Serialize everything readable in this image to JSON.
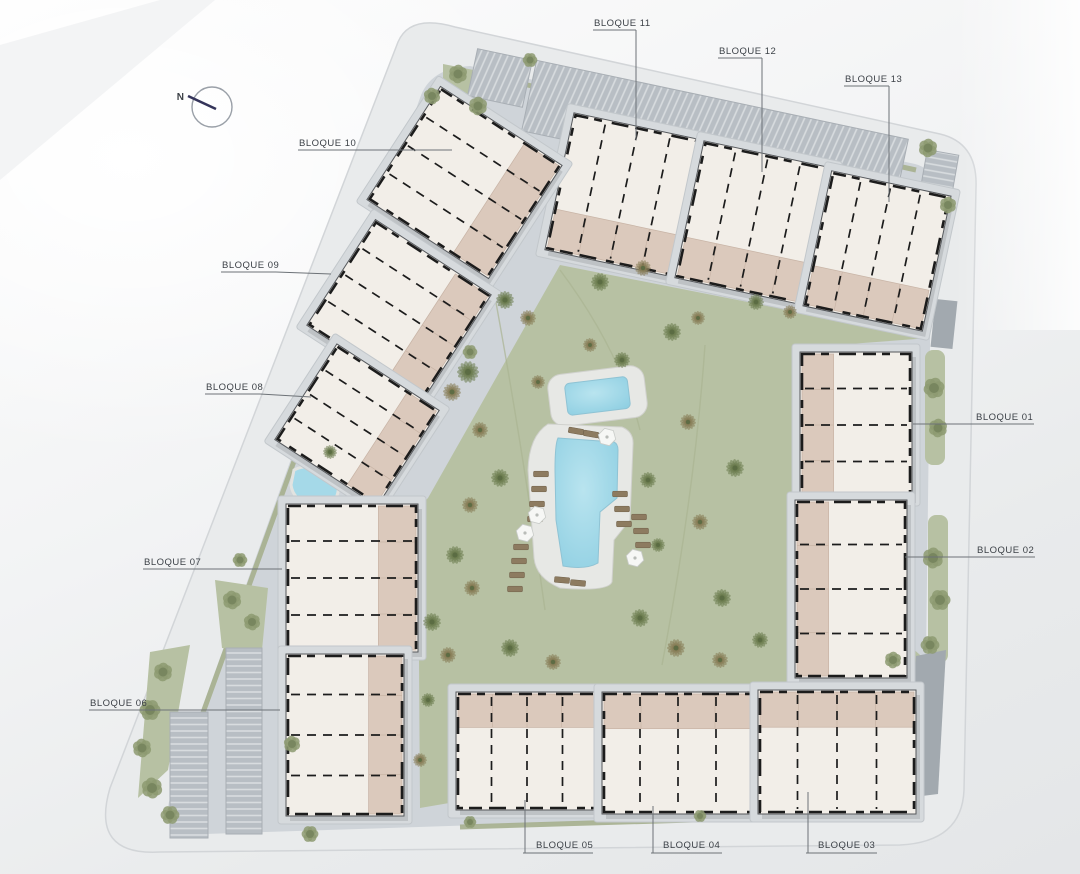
{
  "compass": {
    "label": "N"
  },
  "labels": [
    {
      "id": "bloque-11",
      "text": "BLOQUE 11",
      "tx": 594,
      "ty": 26,
      "ux1": 593,
      "ux2": 636,
      "uy": 30,
      "leader": [
        [
          636,
          30
        ],
        [
          636,
          140
        ]
      ]
    },
    {
      "id": "bloque-12",
      "text": "BLOQUE 12",
      "tx": 719,
      "ty": 54,
      "ux1": 718,
      "ux2": 762,
      "uy": 58,
      "leader": [
        [
          762,
          58
        ],
        [
          762,
          172
        ]
      ]
    },
    {
      "id": "bloque-13",
      "text": "BLOQUE 13",
      "tx": 845,
      "ty": 82,
      "ux1": 844,
      "ux2": 889,
      "uy": 86,
      "leader": [
        [
          889,
          86
        ],
        [
          889,
          202
        ]
      ]
    },
    {
      "id": "bloque-10",
      "text": "BLOQUE 10",
      "tx": 299,
      "ty": 146,
      "ux1": 298,
      "ux2": 353,
      "uy": 150,
      "leader": [
        [
          353,
          150
        ],
        [
          452,
          150
        ]
      ]
    },
    {
      "id": "bloque-09",
      "text": "BLOQUE 09",
      "tx": 222,
      "ty": 268,
      "ux1": 221,
      "ux2": 276,
      "uy": 272,
      "leader": [
        [
          276,
          272
        ],
        [
          331,
          274
        ]
      ]
    },
    {
      "id": "bloque-08",
      "text": "BLOQUE 08",
      "tx": 206,
      "ty": 390,
      "ux1": 205,
      "ux2": 260,
      "uy": 394,
      "leader": [
        [
          260,
          394
        ],
        [
          311,
          397
        ]
      ]
    },
    {
      "id": "bloque-07",
      "text": "BLOQUE 07",
      "tx": 144,
      "ty": 565,
      "ux1": 143,
      "ux2": 198,
      "uy": 569,
      "leader": [
        [
          198,
          569
        ],
        [
          282,
          569
        ]
      ]
    },
    {
      "id": "bloque-06",
      "text": "BLOQUE 06",
      "tx": 90,
      "ty": 706,
      "ux1": 89,
      "ux2": 144,
      "uy": 710,
      "leader": [
        [
          144,
          710
        ],
        [
          280,
          710
        ]
      ]
    },
    {
      "id": "bloque-01",
      "text": "BLOQUE 01",
      "tx": 976,
      "ty": 420,
      "ux1": 975,
      "ux2": 1034,
      "uy": 424,
      "leader": [
        [
          913,
          424
        ],
        [
          975,
          424
        ]
      ]
    },
    {
      "id": "bloque-02",
      "text": "BLOQUE 02",
      "tx": 977,
      "ty": 553,
      "ux1": 976,
      "ux2": 1035,
      "uy": 557,
      "leader": [
        [
          905,
          557
        ],
        [
          976,
          557
        ]
      ]
    },
    {
      "id": "bloque-05",
      "text": "BLOQUE 05",
      "tx": 536,
      "ty": 848,
      "ux1": 523,
      "ux2": 593,
      "uy": 853,
      "leader": [
        [
          525,
          853
        ],
        [
          525,
          800
        ]
      ]
    },
    {
      "id": "bloque-04",
      "text": "BLOQUE 04",
      "tx": 663,
      "ty": 848,
      "ux1": 651,
      "ux2": 722,
      "uy": 853,
      "leader": [
        [
          653,
          853
        ],
        [
          653,
          806
        ]
      ]
    },
    {
      "id": "bloque-03",
      "text": "BLOQUE 03",
      "tx": 818,
      "ty": 848,
      "ux1": 806,
      "ux2": 877,
      "uy": 853,
      "leader": [
        [
          808,
          853
        ],
        [
          808,
          792
        ]
      ]
    }
  ],
  "colors": {
    "road": "#e9ebec",
    "road_edge": "#d2d5d8",
    "pavement": "#cfd4d9",
    "lawn": "#b7c1a3",
    "lawn_dark": "#a9b391",
    "verge": "#a6b08e",
    "water": "#a5d9e8",
    "water_deep": "#8fcfe2",
    "pool_deck": "#e7e8e5",
    "building_fill": "#f2eee8",
    "building_wall": "#1c1c1c",
    "building_edge": "#55585c",
    "terrace": "#dbc9bc",
    "terrace_line": "#c8b4a6",
    "apron": "#d6dadd",
    "apron_edge": "#c2c7cb",
    "parking_base": "#b8bec4",
    "parking_stripe": "#d8dcdf",
    "ramp": "#a2a9af",
    "tree_olive": "#6b7b4f",
    "tree_brown": "#867c55",
    "tree_sage": "#8d9a71",
    "lounger": "#8d7b60",
    "umbrella": "#f6f7f5",
    "label_text": "#3c4147",
    "label_line": "#6d7277",
    "compass_needle": "#34345a",
    "compass_ring": "#9aa0a8"
  }
}
